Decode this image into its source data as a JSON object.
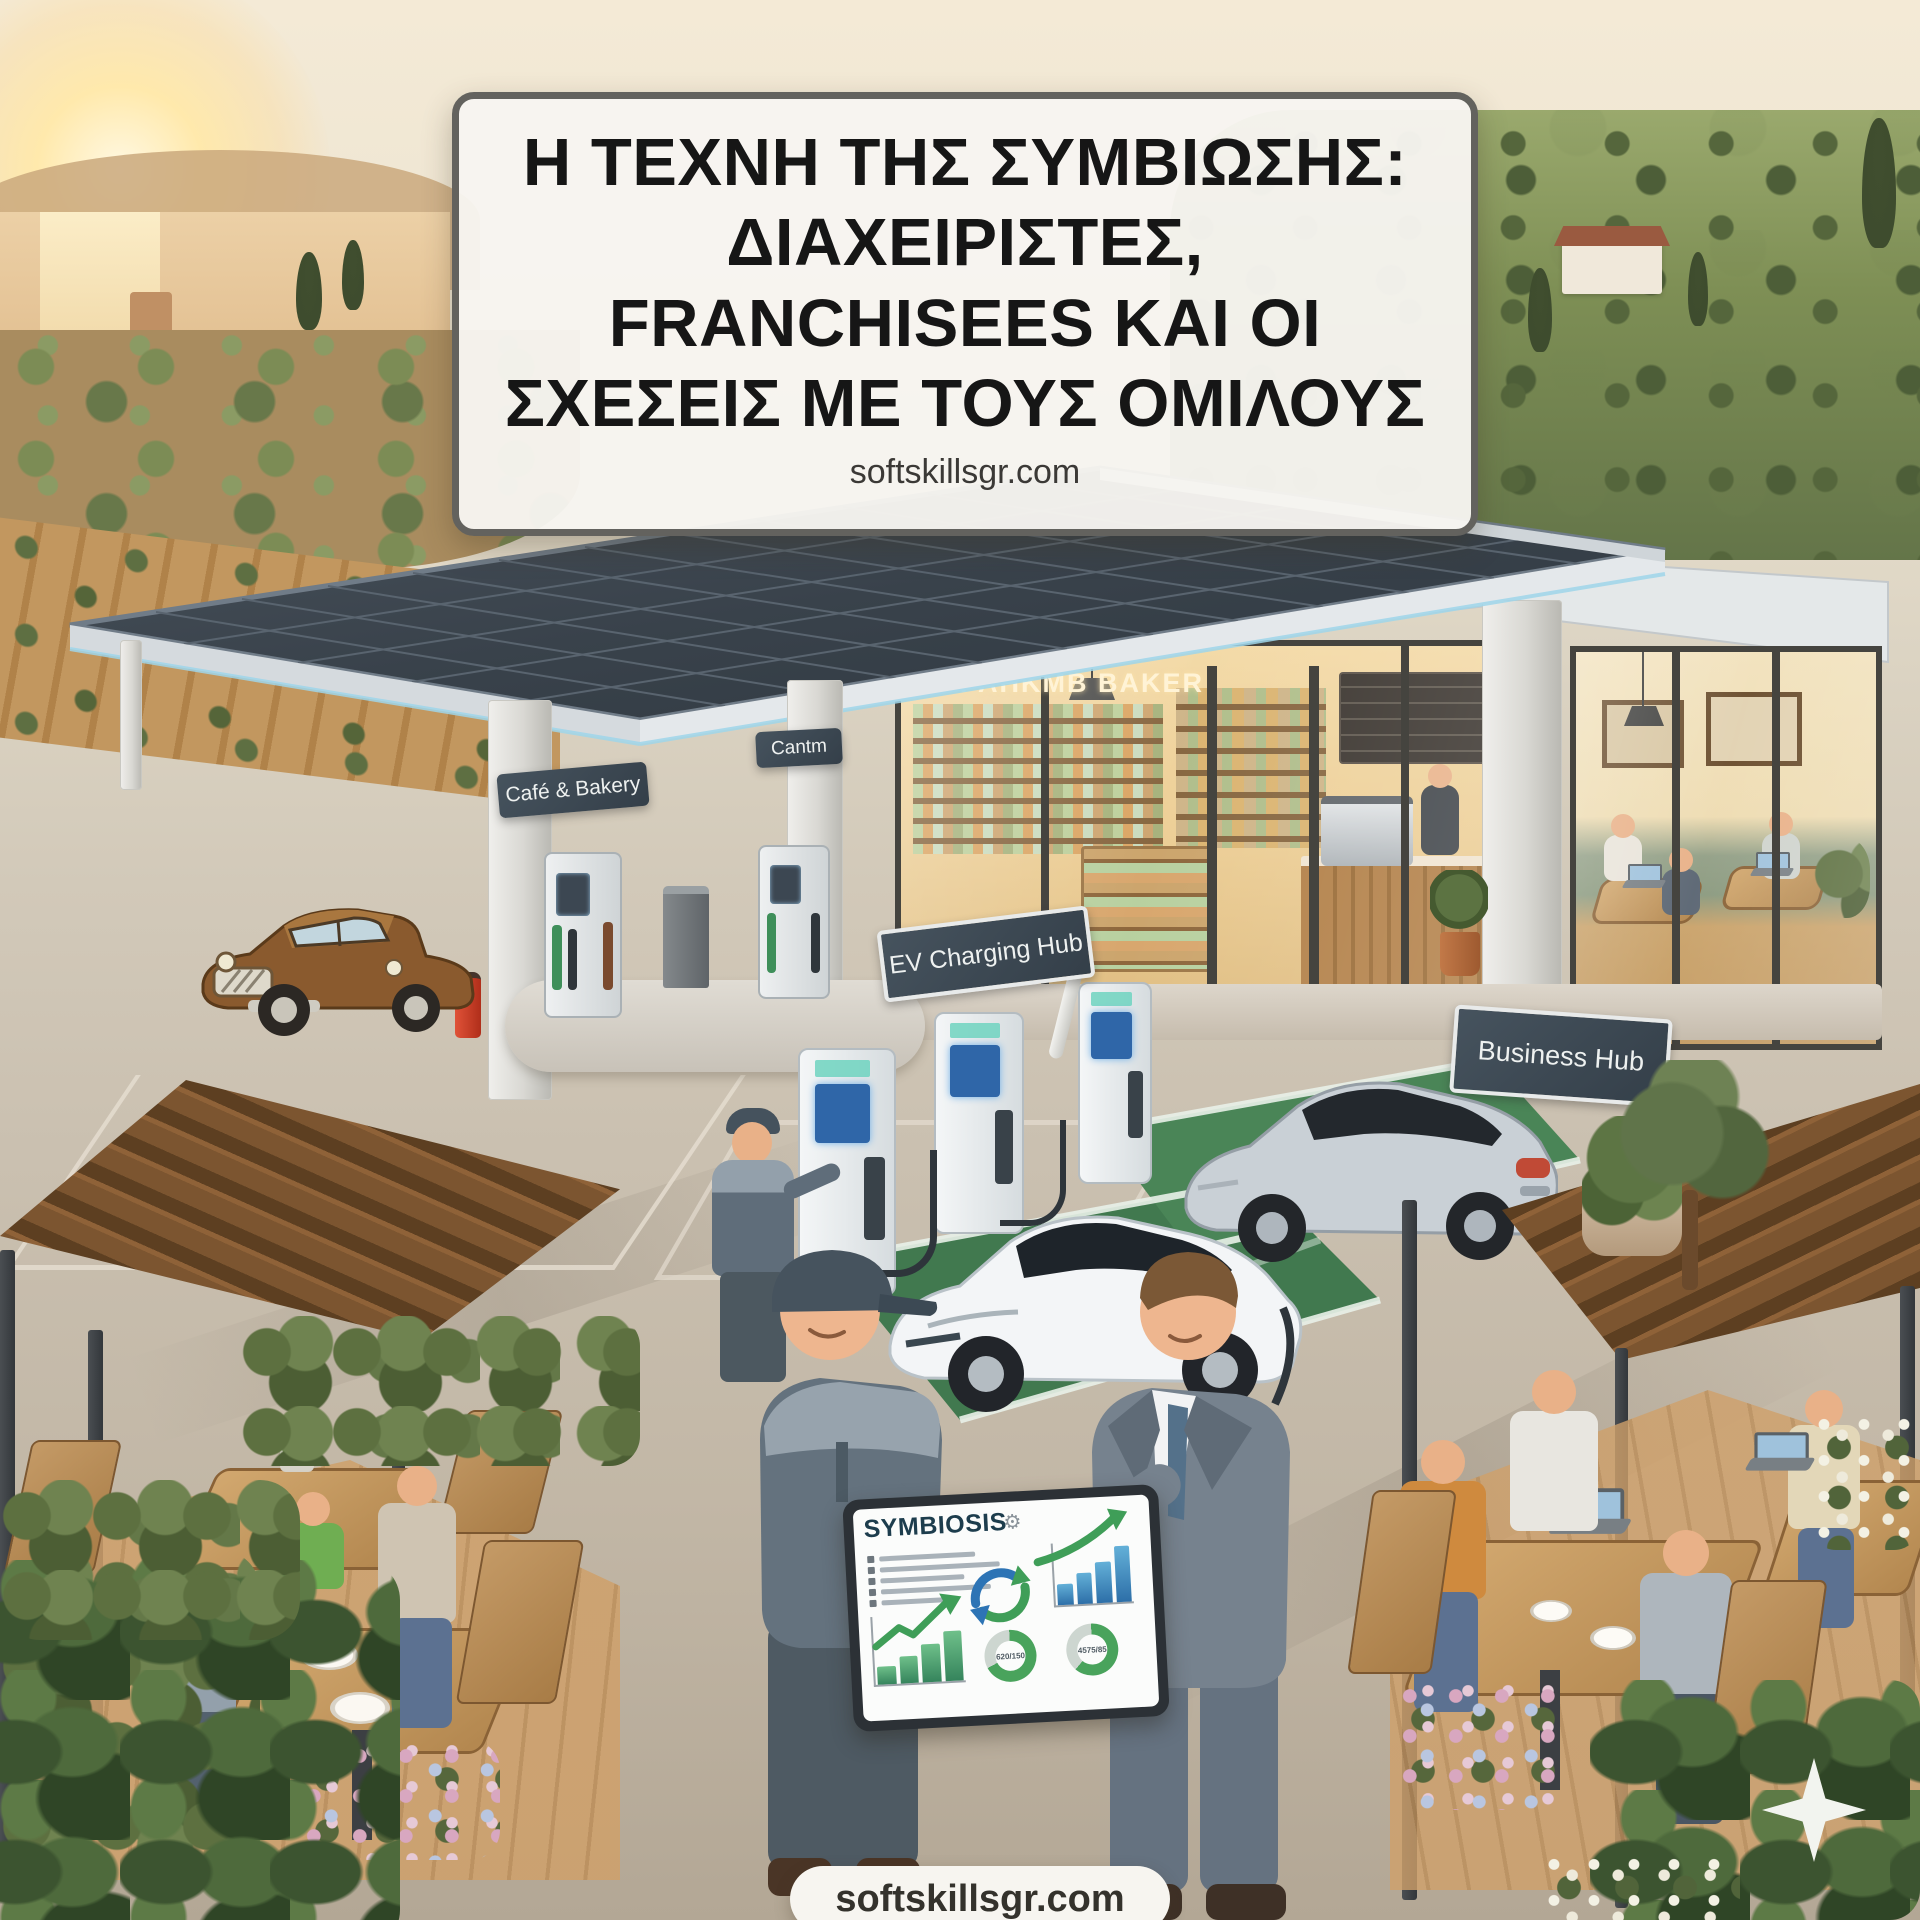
{
  "banner": {
    "title_line1": "Η ΤΕΧΝΗ ΤΗΣ ΣΥΜΒΙΩΣΗΣ:",
    "title_line2": "ΔΙΑΧΕΙΡΙΣΤΕΣ,",
    "title_line3": "FRANCHISEES ΚΑΙ ΟΙ",
    "title_line4": "ΣΧΕΣΕΙΣ ΜΕ ΤΟΥΣ ΟΜΙΛΟΥΣ",
    "website": "softskillsgr.com"
  },
  "signs": {
    "cafe_bakery": "Café & Bakery",
    "canteen": "Cantm",
    "storefront": "PAHKMB BAKER",
    "ev_charging_hub": "EV Charging Hub",
    "business_hub": "Business Hub"
  },
  "tablet": {
    "title": "SYMBIOSIS",
    "gear_icon": "⚙",
    "donut_left_value": "620/150",
    "donut_right_value": "4575/85",
    "bars_left": [
      26,
      40,
      56,
      74
    ],
    "bars_right": [
      34,
      50,
      66,
      90
    ]
  },
  "footer": {
    "website": "softskillsgr.com"
  },
  "colors": {
    "accent_green": "#3f9e58",
    "accent_blue": "#2d74b5",
    "sign_slate": "#3d4a54",
    "ev_bay_green": "#41794f"
  }
}
